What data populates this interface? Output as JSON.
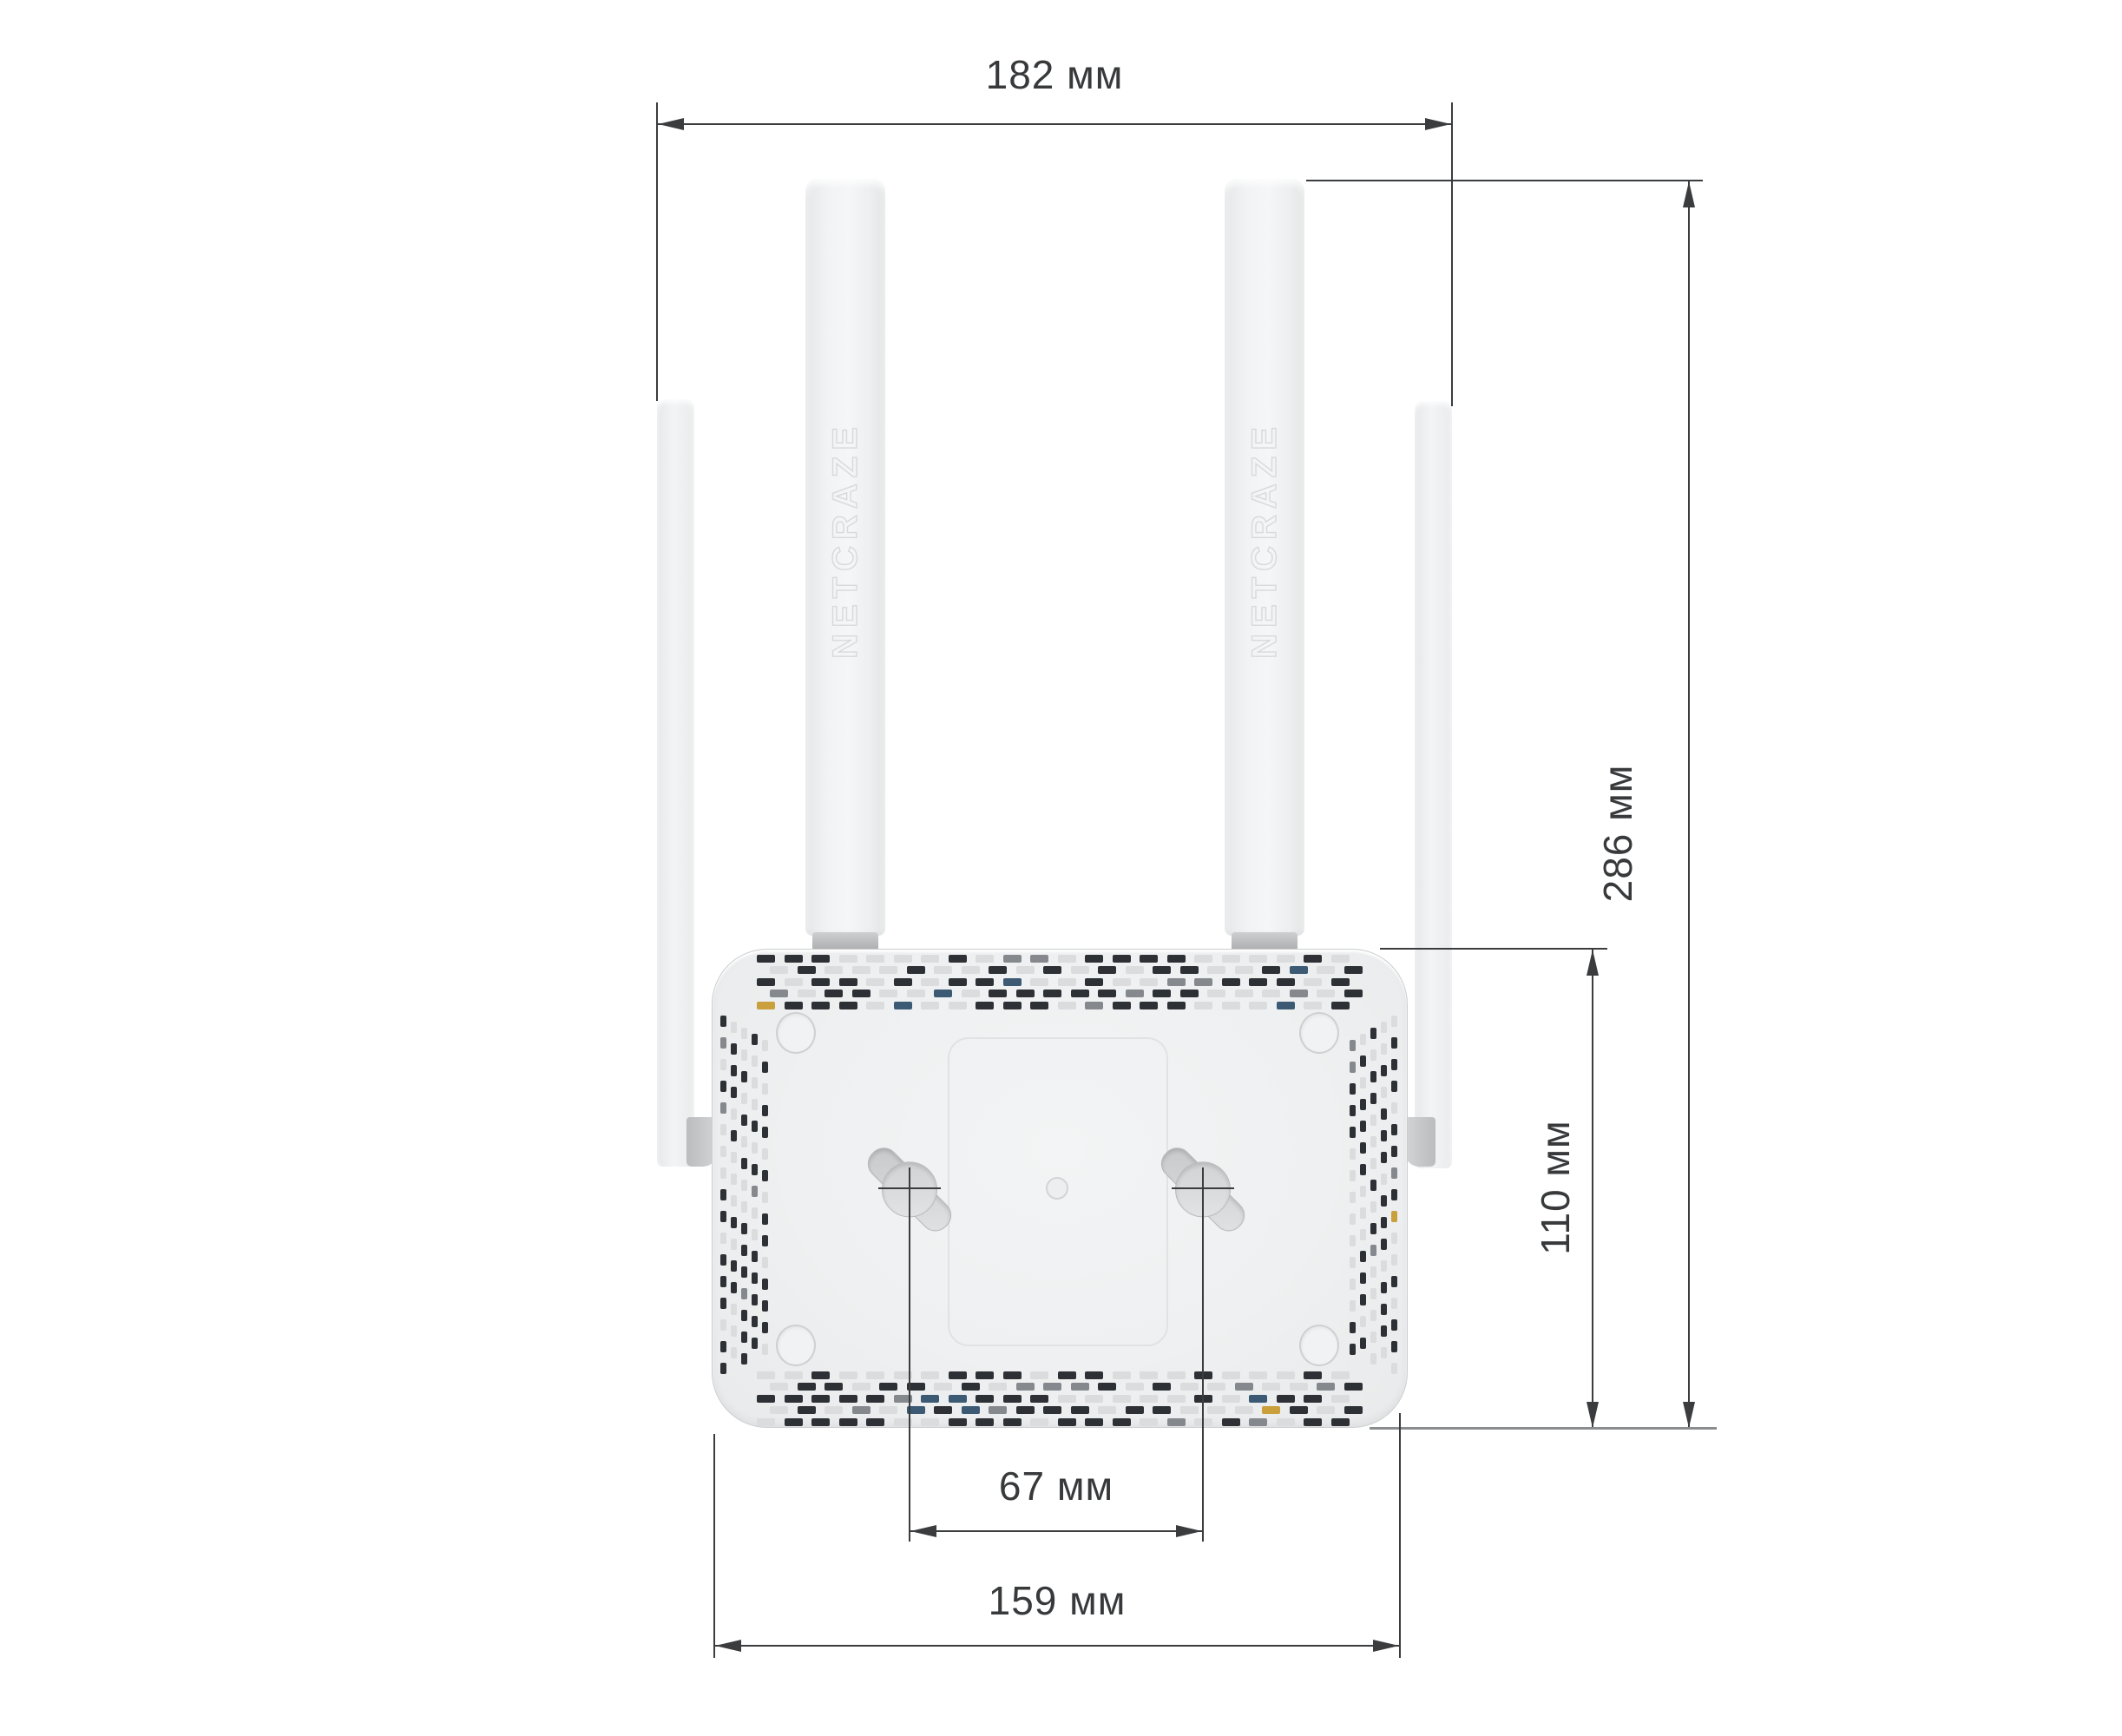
{
  "diagram": {
    "brand": "NETCRAZE",
    "dimensions": {
      "antenna_span_width": "182 мм",
      "total_height": "286 мм",
      "body_height": "110 мм",
      "mount_hole_spacing": "67 мм",
      "body_width": "159 мм"
    },
    "colors": {
      "line": "#3a3c3e",
      "text": "#37393b",
      "body_fill": "#eef0f1",
      "antenna_fill": "#f2f3f4",
      "metal": "#c2c4c6",
      "vent_dark": "#2d3034",
      "vent_mid": "#85898d",
      "vent_light": "#dadcde",
      "vent_blue": "#3c5a74",
      "vent_yellow": "#c9a03c"
    }
  }
}
